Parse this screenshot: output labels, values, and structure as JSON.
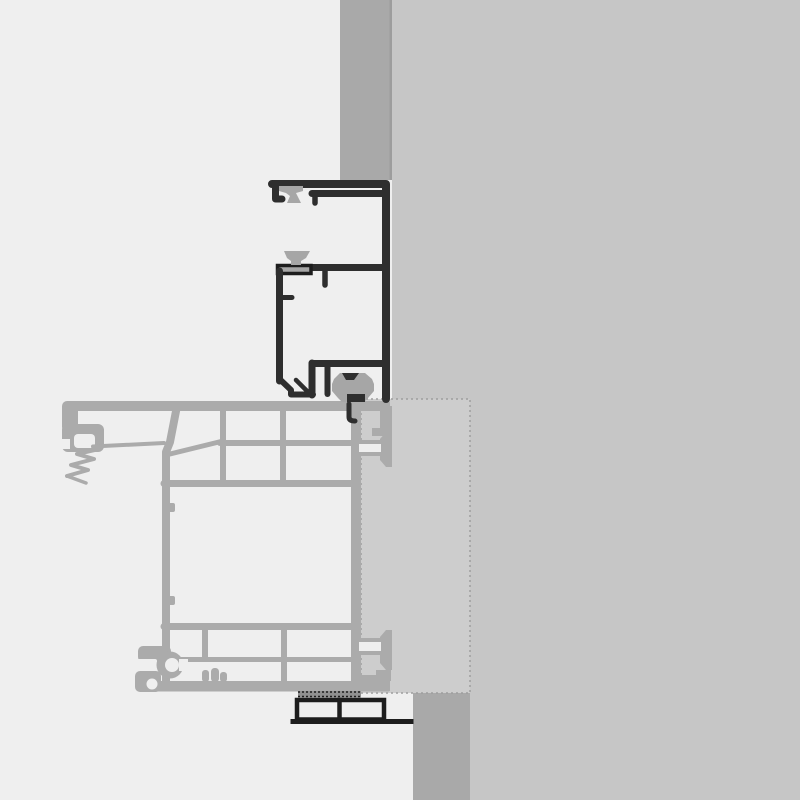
{
  "colors": {
    "background": "#efefef",
    "wall_slab": "#c6c6c6",
    "wall_column": "#a9a9a9",
    "wall_column_edge": "#9d9d9d",
    "insulation_panel": "#cdcdcd",
    "panel_edge": "#9e9e9e",
    "profile_light": "#ababab",
    "profile_dark": "#2e2e2e",
    "gasket": "#a6a6a6",
    "shim_strip": "#909090",
    "packer_dark": "#1d1d1d"
  }
}
